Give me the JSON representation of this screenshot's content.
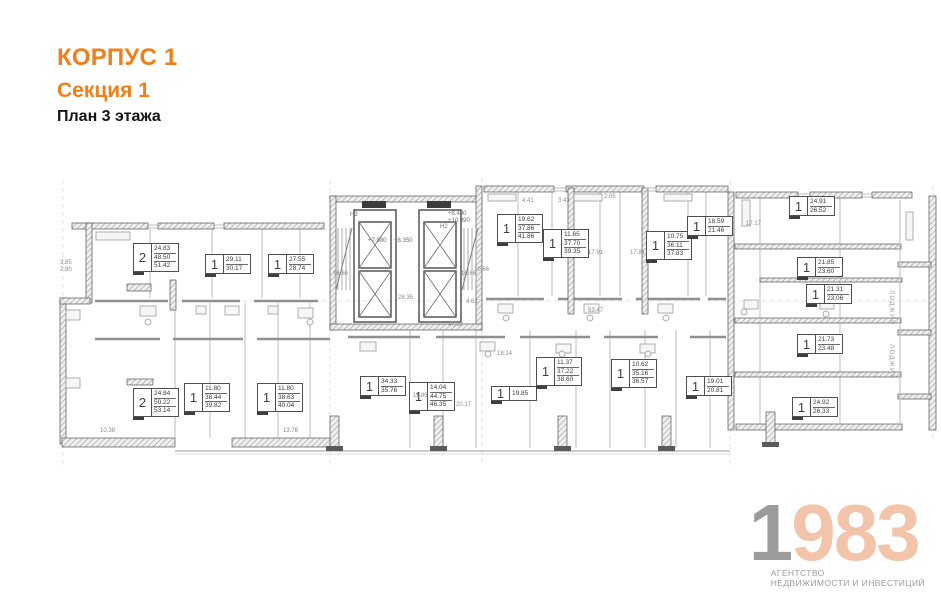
{
  "header": {
    "building": "КОРПУС 1",
    "section": "Секция 1",
    "floor": "План 3 этажа"
  },
  "logo": {
    "digit_gray": "1",
    "digits_accent": "983",
    "tagline_line1": "АГЕНТСТВО",
    "tagline_line2": "НЕДВИЖИМОСТИ И ИНВЕСТИЦИЙ"
  },
  "colors": {
    "accent_orange": "#EF7F1B",
    "logo_gray": "#9B9B9B",
    "logo_peach": "#F2C4A9",
    "wall_dark": "#4A4A4A",
    "line_light": "#C2C2C2"
  },
  "plan": {
    "apartments": [
      {
        "rooms": "2",
        "areas": [
          "24.83",
          "48.50",
          "51.42"
        ],
        "x": 133,
        "y": 243
      },
      {
        "rooms": "1",
        "areas": [
          "29.11",
          "30.17"
        ],
        "x": 205,
        "y": 254
      },
      {
        "rooms": "1",
        "areas": [
          "27.55",
          "28.74"
        ],
        "x": 268,
        "y": 254
      },
      {
        "rooms": "1",
        "areas": [
          "19.62",
          "37.86",
          "41.86"
        ],
        "x": 497,
        "y": 214
      },
      {
        "rooms": "1",
        "areas": [
          "11.65",
          "37.70",
          "39.35"
        ],
        "x": 543,
        "y": 229
      },
      {
        "rooms": "1",
        "areas": [
          "10.75",
          "36.11",
          "37.83"
        ],
        "x": 646,
        "y": 231
      },
      {
        "rooms": "1",
        "areas": [
          "18.59",
          "21.46"
        ],
        "x": 687,
        "y": 216
      },
      {
        "rooms": "1",
        "areas": [
          "24.91",
          "26.52"
        ],
        "x": 789,
        "y": 196
      },
      {
        "rooms": "1",
        "areas": [
          "21.85",
          "23.60"
        ],
        "x": 797,
        "y": 257
      },
      {
        "rooms": "1",
        "areas": [
          "21.31",
          "23.06"
        ],
        "x": 806,
        "y": 284
      },
      {
        "rooms": "1",
        "areas": [
          "21.73",
          "23.48"
        ],
        "x": 797,
        "y": 334
      },
      {
        "rooms": "1",
        "areas": [
          "24.92",
          "26.33"
        ],
        "x": 792,
        "y": 397
      },
      {
        "rooms": "2",
        "areas": [
          "24.84",
          "50.22",
          "53.14"
        ],
        "x": 133,
        "y": 388
      },
      {
        "rooms": "1",
        "areas": [
          "11.80",
          "38.44",
          "39.82"
        ],
        "x": 184,
        "y": 383
      },
      {
        "rooms": "1",
        "areas": [
          "11.80",
          "38.63",
          "40.04"
        ],
        "x": 257,
        "y": 383
      },
      {
        "rooms": "1",
        "areas": [
          "34.33",
          "35.76"
        ],
        "x": 360,
        "y": 376
      },
      {
        "rooms": "1",
        "areas": [
          "14.04",
          "44.75",
          "46.35"
        ],
        "x": 409,
        "y": 382
      },
      {
        "rooms": "1",
        "areas": [
          "19.85"
        ],
        "x": 491,
        "y": 386
      },
      {
        "rooms": "1",
        "areas": [
          "11.37",
          "37.22",
          "38.60"
        ],
        "x": 536,
        "y": 357
      },
      {
        "rooms": "1",
        "areas": [
          "10.62",
          "35.16",
          "36.57"
        ],
        "x": 611,
        "y": 359
      },
      {
        "rooms": "1",
        "areas": [
          "19.01",
          "20.81"
        ],
        "x": 686,
        "y": 376
      }
    ],
    "dimensions": [
      {
        "text": "16.66",
        "x": 333,
        "y": 271
      },
      {
        "text": "16.66",
        "x": 461,
        "y": 271
      },
      {
        "text": "28.35",
        "x": 398,
        "y": 295
      },
      {
        "text": "4.62",
        "x": 466,
        "y": 299
      },
      {
        "text": "47.19",
        "x": 448,
        "y": 322
      },
      {
        "text": "53.47",
        "x": 588,
        "y": 308
      },
      {
        "text": "17.91",
        "x": 588,
        "y": 250
      },
      {
        "text": "17.81",
        "x": 630,
        "y": 250
      },
      {
        "text": "10.66",
        "x": 474,
        "y": 267
      },
      {
        "text": "20.17",
        "x": 456,
        "y": 402
      },
      {
        "text": "18.14",
        "x": 497,
        "y": 351
      },
      {
        "text": "13.78",
        "x": 283,
        "y": 428
      },
      {
        "text": "17.17",
        "x": 746,
        "y": 221
      },
      {
        "text": "11.86",
        "x": 413,
        "y": 393
      },
      {
        "text": "4.41",
        "x": 522,
        "y": 198
      },
      {
        "text": "3.43",
        "x": 558,
        "y": 198
      },
      {
        "text": "2.05",
        "x": 604,
        "y": 194
      },
      {
        "text": "3.85",
        "x": 60,
        "y": 260
      },
      {
        "text": "2.80",
        "x": 60,
        "y": 267
      },
      {
        "text": "10.38",
        "x": 100,
        "y": 428
      }
    ],
    "levels": [
      {
        "text": "+8.480",
        "x": 448,
        "y": 211
      },
      {
        "text": "+10.890",
        "x": 448,
        "y": 218
      },
      {
        "text": "+7.980",
        "x": 368,
        "y": 238
      },
      {
        "text": "+8.350",
        "x": 394,
        "y": 238
      },
      {
        "text": "Н3",
        "x": 350,
        "y": 212
      },
      {
        "text": "Н2",
        "x": 440,
        "y": 224
      }
    ],
    "loggias": [
      {
        "text": "ЛОДЖИЯ",
        "x": 888,
        "y": 290
      },
      {
        "text": "ЛОДЖИЯ",
        "x": 888,
        "y": 344
      }
    ]
  }
}
